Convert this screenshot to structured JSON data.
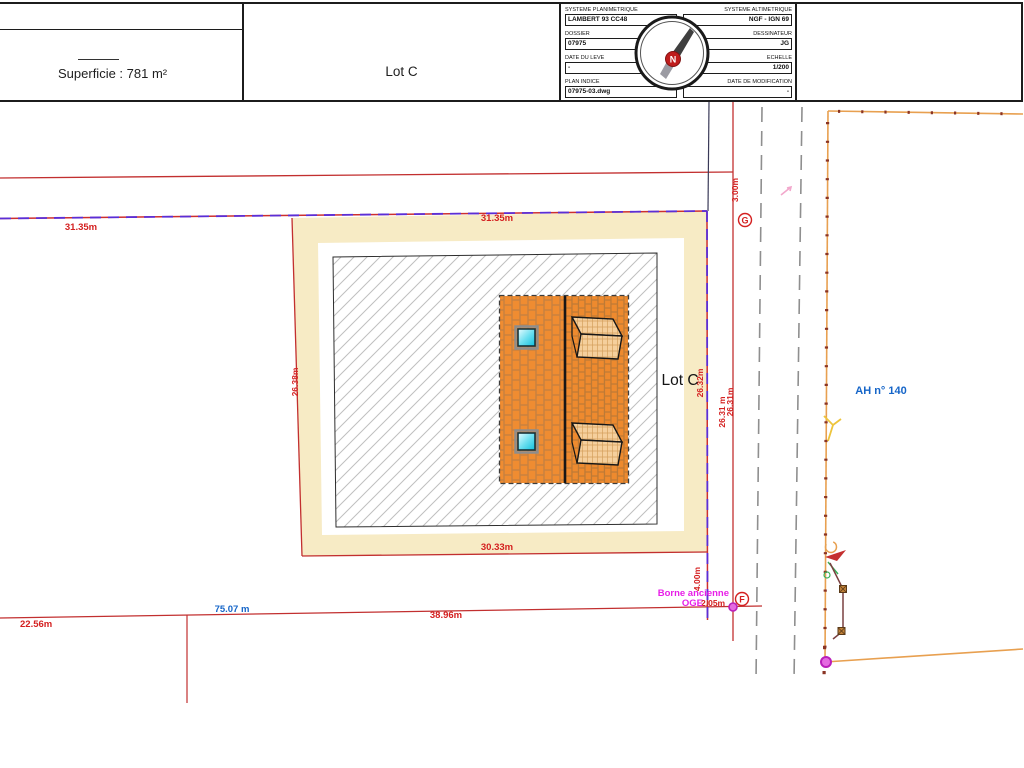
{
  "header": {
    "left_panel": {
      "area_label": "Superficie : 781 m²"
    },
    "center_panel": {
      "lot_label": "Lot C"
    },
    "info_table": {
      "rows": [
        {
          "l_label": "SYSTEME PLANIMETRIQUE",
          "l_value": "LAMBERT 93 CC48",
          "r_label": "SYSTEME ALTIMETRIQUE",
          "r_value": "NGF - IGN 69"
        },
        {
          "l_label": "DOSSIER",
          "l_value": "07975",
          "r_label": "DESSINATEUR",
          "r_value": "JG"
        },
        {
          "l_label": "DATE DU LEVE",
          "l_value": "-",
          "r_label": "ECHELLE",
          "r_value": "1/200"
        },
        {
          "l_label": "PLAN INDICE",
          "l_value": "07975-03.dwg",
          "r_label": "DATE DE MODIFICATION",
          "r_value": "-"
        }
      ],
      "compass_letter": "N"
    }
  },
  "plan": {
    "lot_name": "Lot C",
    "parcel_ref": "AH n° 140",
    "borne_line1": "Borne ancienne",
    "borne_line2": "OGE",
    "point_g": "G",
    "point_f": "F",
    "dims": {
      "top_west": "31.35m",
      "top_lot": "31.35m",
      "west_side": "26.38m",
      "east_side": "26.32m",
      "east_outer_a": "26.31 m",
      "east_outer_b": "26.31m",
      "south_lot": "30.33m",
      "south_mid": "38.96m",
      "south_west": "22.56m",
      "road_length": "75.07 m",
      "strip_north": "3.00m",
      "strip_south": "4.00m",
      "borne_offset": "2.05m"
    },
    "colors": {
      "dimension_red": "#d42020",
      "boundary_purple": "#5b2ed6",
      "lot_fill": "#f7ebc5",
      "roof_orange": "#ee8a2e",
      "fence_orange": "#e8a050",
      "borne_magenta": "#e81ee8",
      "parcel_blue": "#1565c8"
    }
  }
}
